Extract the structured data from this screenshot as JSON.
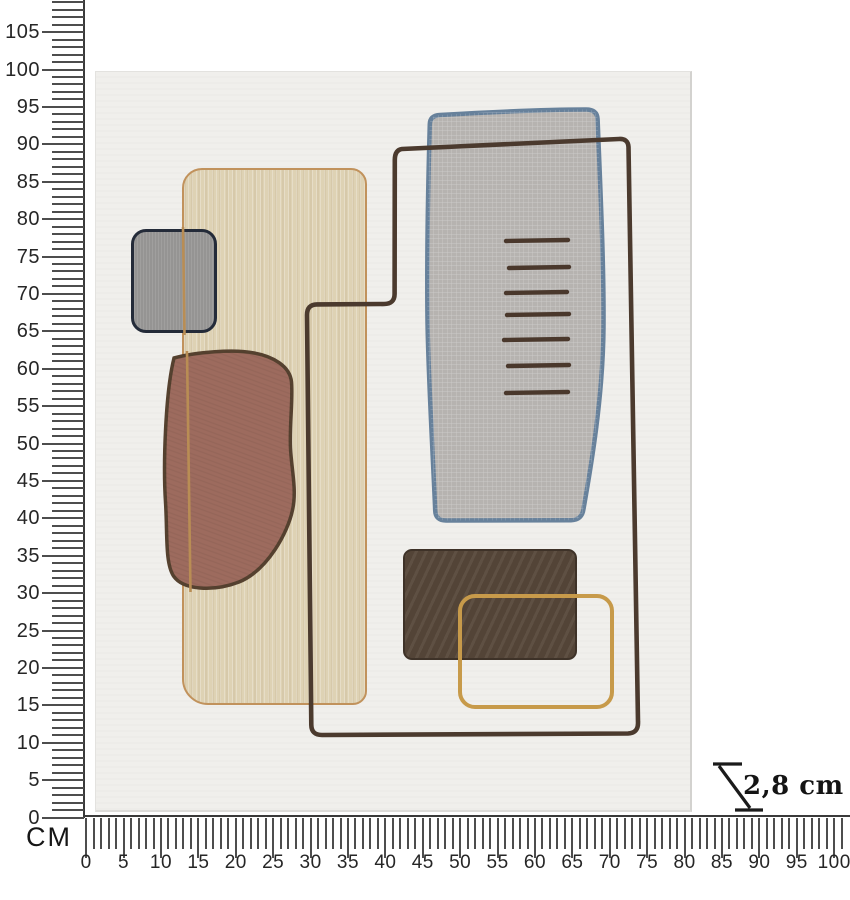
{
  "rulers": {
    "unit": "CM",
    "vertical": {
      "labels": [
        105,
        100,
        95,
        90,
        85,
        80,
        75,
        70,
        65,
        60,
        55,
        50,
        45,
        40,
        35,
        30,
        25,
        20,
        15,
        10,
        5,
        0
      ]
    },
    "horizontal": {
      "labels": [
        0,
        5,
        10,
        15,
        20,
        25,
        30,
        35,
        40,
        45,
        50,
        55,
        60,
        65,
        70,
        75,
        80,
        85,
        90,
        95,
        100
      ]
    }
  },
  "depth": {
    "label": "2,8 cm"
  },
  "palette": {
    "canvas-fill": "#f0efec",
    "beige-fill": "#ded2b4",
    "beige-line": "#c1925c",
    "gray-square-fill": "#959493",
    "gray-square-line": "#242b39",
    "terracotta-fill": "#9d6b5e",
    "terracotta-line": "#55412f",
    "panel-gray-fill": "#b6b3b0",
    "panel-gray-line": "#67819b",
    "dark-brown-fill": "#564739",
    "orange-line": "#c79a4a",
    "loop-line": "#4b3a2e",
    "dash-line": "#4a382c",
    "tan-line": "#b98d54"
  }
}
